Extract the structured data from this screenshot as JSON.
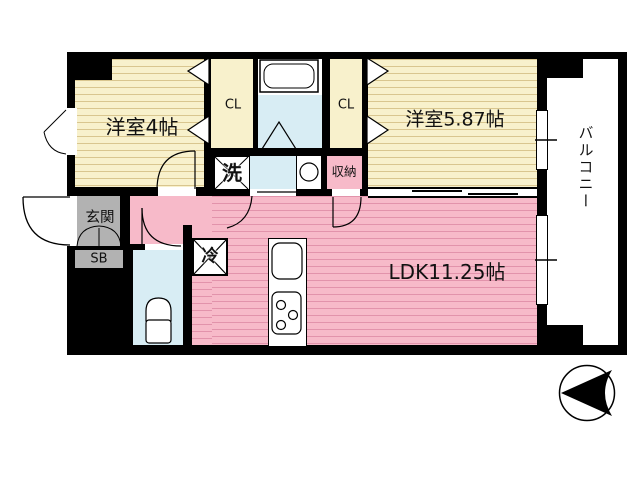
{
  "floorplan": {
    "rooms": {
      "bedroom1": "洋室4帖",
      "bedroom2": "洋室5.87帖",
      "ldk": "LDK11.25帖",
      "closet_left": "CL",
      "closet_right": "CL",
      "storage": "収納",
      "laundry": "洗",
      "refrigerator": "冷",
      "entrance": "玄関",
      "shoebox": "SB",
      "balcony": "バルコニー"
    },
    "colors": {
      "wall": "#000000",
      "room_yellow": "#f8f1cc",
      "room_yellow_stripe": "#d9c68f",
      "room_pink": "#f7bac9",
      "room_pink_stripe": "#e293ab",
      "wet_area_blue": "#d8edf4",
      "entrance_gray": "#b2b2b2",
      "background": "#ffffff"
    }
  }
}
